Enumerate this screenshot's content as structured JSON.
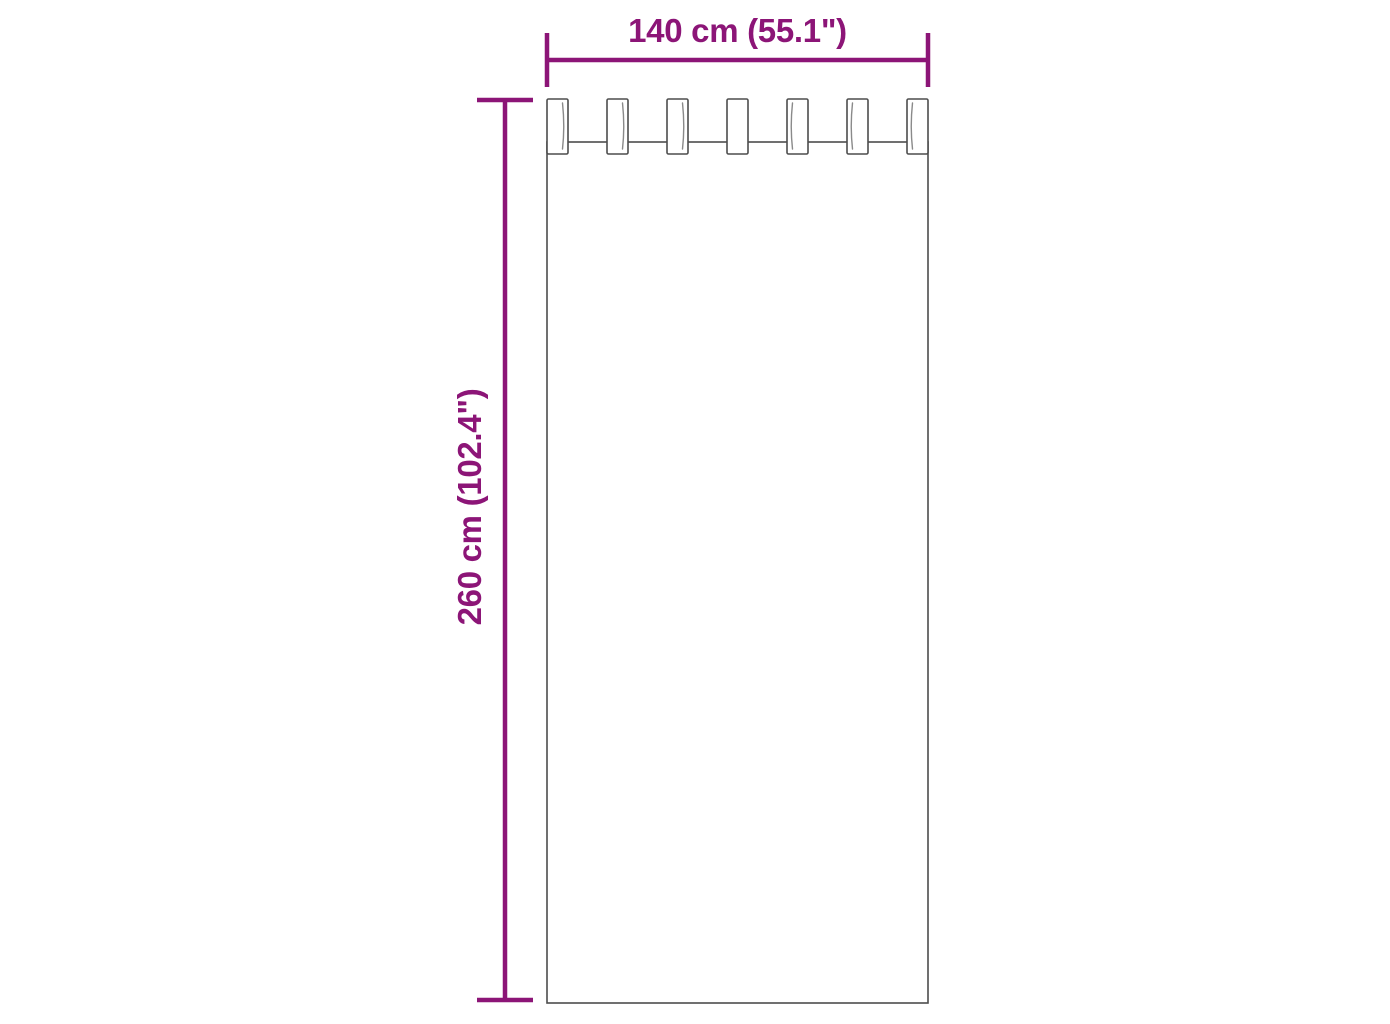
{
  "diagram": {
    "type": "product-dimension-diagram",
    "subject": "tab-top curtain front view",
    "tab_count": 7,
    "dimensions": {
      "width_label": "140 cm (55.1\")",
      "height_label": "260 cm (102.4\")"
    }
  },
  "colors": {
    "dimension_accent": "#8C1577",
    "curtain_outline": "#4D4D4D",
    "background": "#FFFFFF"
  }
}
